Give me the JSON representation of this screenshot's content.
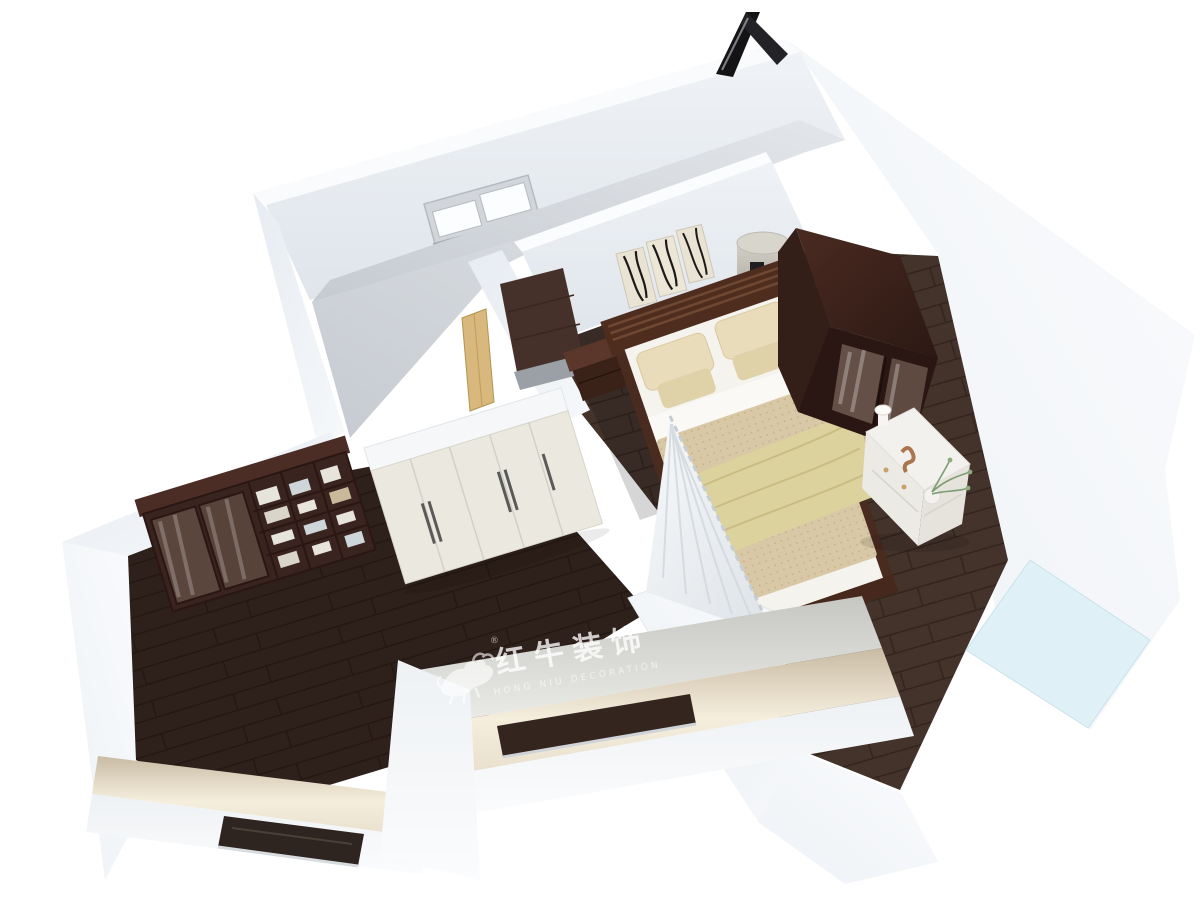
{
  "watermark": {
    "title_cn": "红牛装饰",
    "subtitle_en": "HONG NIU DECORATION",
    "registered": "®"
  },
  "palette": {
    "background": "#ffffff",
    "wall_light": "#f2f5f9",
    "wall_shadow": "#dde3ea",
    "floor_bedroom_dark": "#3b2a23",
    "floor_corridor": "#43332b",
    "floor_study": "#2e201b",
    "floor_empty_gray": "#d3d7dc",
    "balcony_floor": "#dff0f6",
    "furniture_dark_wood": "#3a2420",
    "furniture_light_wood": "#d9b87d",
    "bedding_beige": "#d8c8a6",
    "blanket_yellow": "#dcd29e",
    "pillow_beige": "#e8dcba",
    "accent_black": "#141417",
    "watermark_color": "rgba(255,255,255,0.78)",
    "watermark_color_dim": "rgba(255,255,255,0.6)"
  }
}
